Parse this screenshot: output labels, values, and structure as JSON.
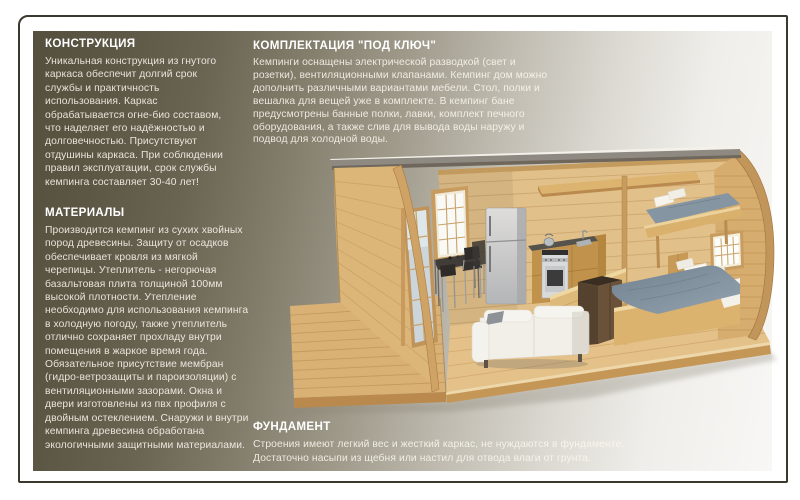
{
  "sections": {
    "construction": {
      "title": "КОНСТРУКЦИЯ",
      "body": "Уникальная конструкция из гнутого\nкаркаса обеспечит долгий срок\nслужбы и практичность\nиспользования. Каркас\nобрабатывается огне-био составом,\nчто наделяет его надёжностью и\nдолговечностью. Присутствуют\nотдушины каркаса. При соблюдении\nправил эксплуатации, срок службы\nкемпинга составляет 30-40 лет!"
    },
    "materials": {
      "title": "МАТЕРИАЛЫ",
      "body": "Производится кемпинг из сухих хвойных\nпород древесины. Защиту от осадков\nобеспечивает кровля из мягкой\nчерепицы. Утеплитель - негорючая\nбазальтовая плита толщиной 100мм\nвысокой плотности. Утепление\nнеобходимо для использования кемпинга\nв холодную погоду, также утеплитель\nотлично сохраняет прохладу внутри\nпомещения в жаркое время года.\nОбязательное присутствие мембран\n(гидро-ветрозащиты и пароизоляции) с\nвентиляционными зазорами. Окна и\nдвери изготовлены из пвх профиля с\nдвойным остеклением. Снаружи и внутри\nкемпинга древесина обработана\nэкологичными защитными материалами."
    },
    "turnkey": {
      "title": "КОМПЛЕКТАЦИЯ \"ПОД КЛЮЧ\"",
      "body": "Кемпинги оснащены электрической разводкой (свет и\nрозетки), вентиляционными клапанами. Кемпинг дом можно\nдополнить различными вариантами мебели. Стол, полки и\nвешалка для вещей уже в комплекте. В кемпинг бане\nпредусмотрены банные полки, лавки, комплект печного\nоборудования, а также слив для вывода воды наружу и\nподвод для холодной воды."
    },
    "foundation": {
      "title": "ФУНДАМЕНТ",
      "body": "Строения имеют легкий вес и жесткий каркас, не нуждаются в фундаменте.\nДостаточно насыпи из щебня или настил для отвода влаги от грунта."
    }
  },
  "illustration": {
    "house_alt": "3D-визуализация кемпинг-дома с бочкообразной крышей в разрезе: терраса, стеклянная дверь, кухня, холодильник, стол со стульями, диван, кровать и спальное место на антресоли"
  },
  "colors": {
    "panel_dark": "#554f3d",
    "panel_light": "#f8f7f5",
    "frame_border": "#3b382d",
    "heading_text": "#ffffff",
    "body_text": "rgba(250,247,238,0.88)",
    "wood_light": "#e2c089",
    "wood_mid": "#cfa265",
    "mattress_blue_gray": "#8595a2"
  }
}
